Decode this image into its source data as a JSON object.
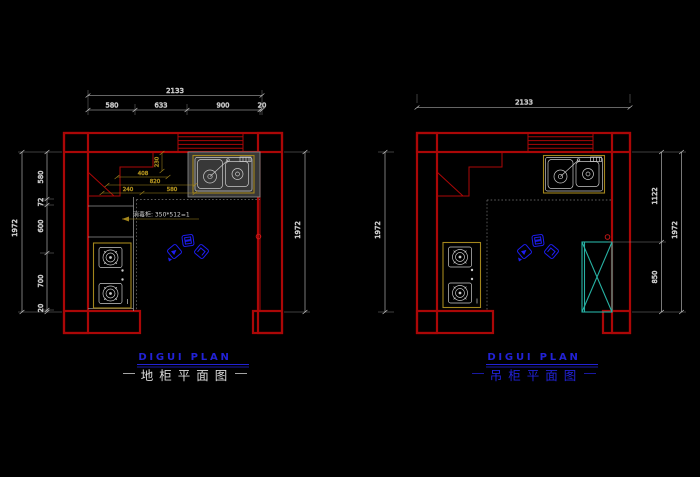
{
  "app": {
    "type": "cad-kitchen-cabinet-plan",
    "background": "#000000"
  },
  "colors": {
    "wall_red": "#ab0707",
    "dim_white": "#dedede",
    "gold": "#a3861c",
    "title_blue": "#2222d6",
    "logo_blue": "#1d1df2",
    "cabinet_cyan": "#27b1a3",
    "counter_gray": "#8f8f8f"
  },
  "left_plan": {
    "title_en": "DIGUI PLAN",
    "title_cn": "地柜平面图",
    "dim_top": {
      "total": "2133",
      "segments": [
        "580",
        "633",
        "900",
        "20"
      ]
    },
    "dim_left": {
      "total": "1972",
      "segments": [
        "580",
        "72",
        "600",
        "700",
        "20"
      ]
    },
    "dim_right": {
      "total": "1972"
    },
    "dim_interior": {
      "depth": "230",
      "w1": "408",
      "w2": "820",
      "w3": "240",
      "w4": "580"
    },
    "annotation": "消毒柜: 350*512=1"
  },
  "right_plan": {
    "title_en": "DIGUI PLAN",
    "title_cn": "吊柜平面图",
    "dim_top": {
      "total": "2133"
    },
    "dim_left": {
      "total": "1972"
    },
    "dim_right": {
      "total": "1972",
      "segments": [
        "1122",
        "850"
      ]
    }
  }
}
